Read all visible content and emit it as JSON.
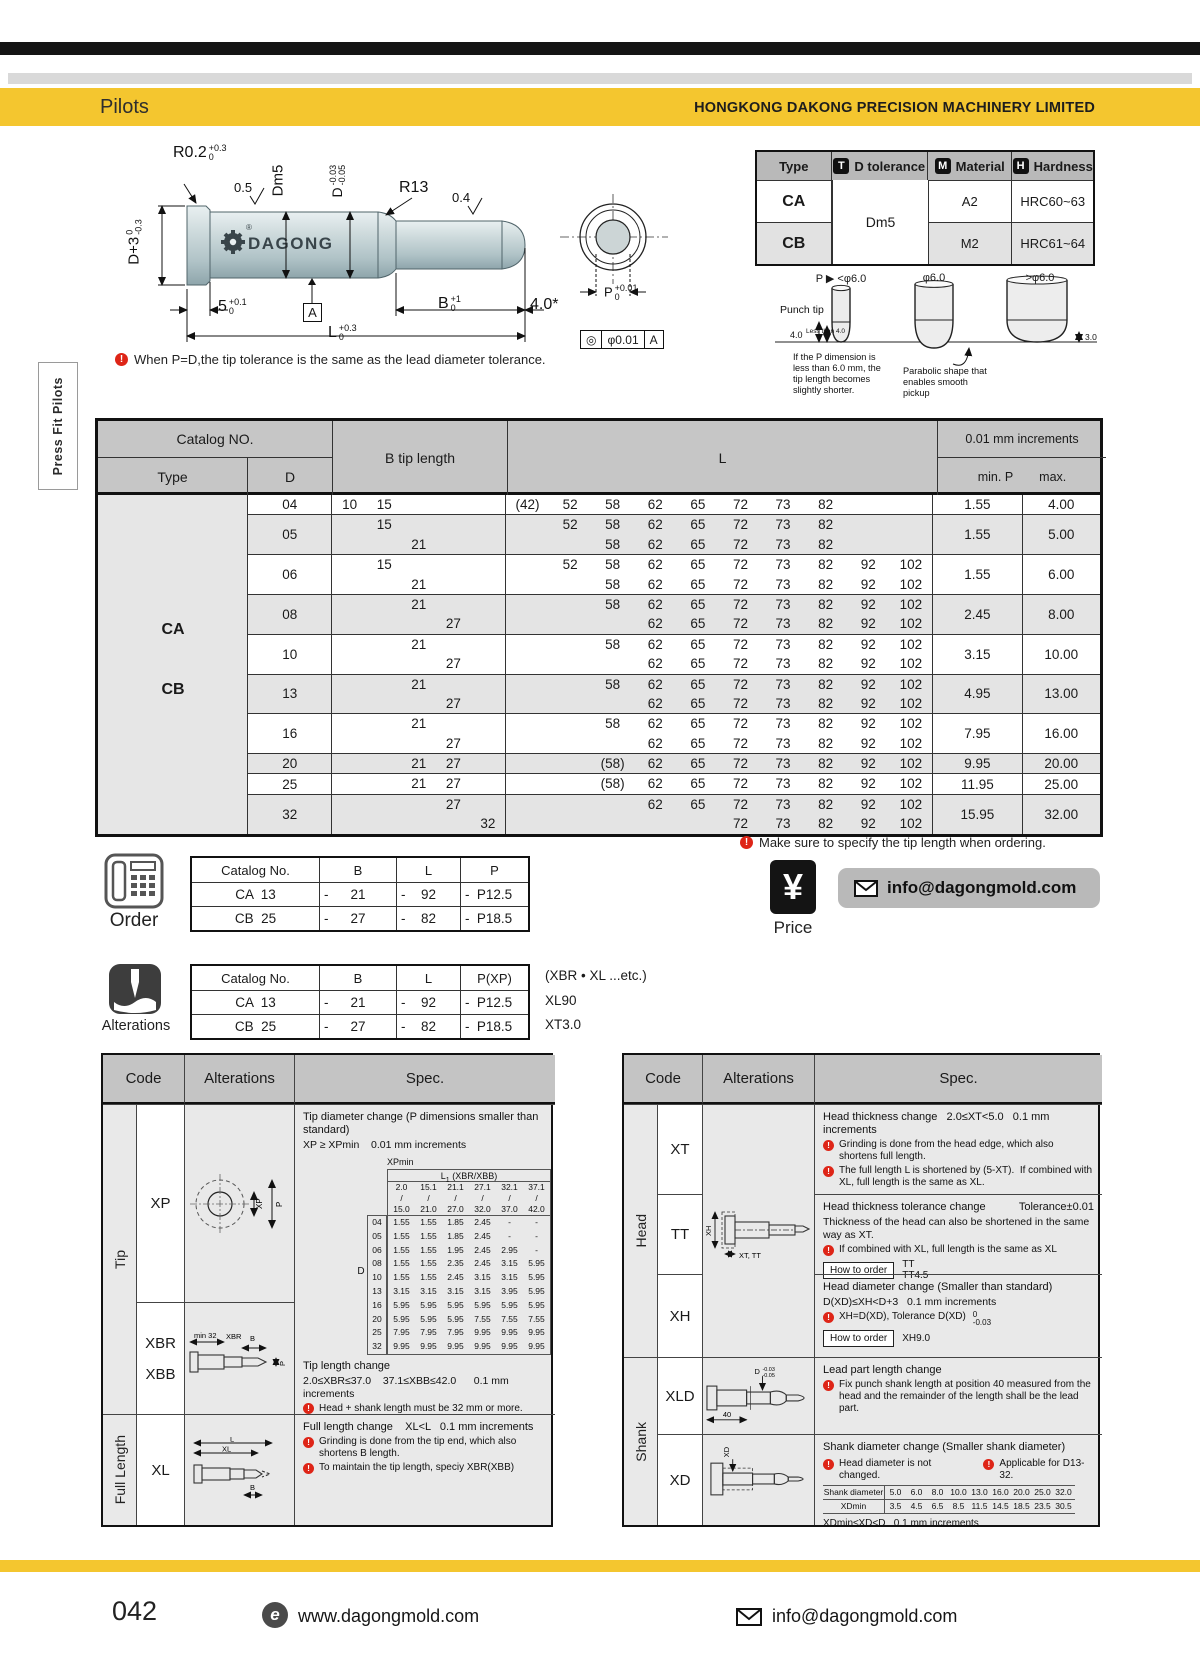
{
  "header": {
    "section_title": "Pilots",
    "company": "HONGKONG DAKONG PRECISION MACHINERY LIMITED"
  },
  "side_tab": {
    "label": "Press Fit Pilots"
  },
  "drawing": {
    "logo_text": "DAGONG",
    "logo_reg": "®",
    "dims": {
      "r02": {
        "base": "R0.2",
        "sup": "+0.3",
        "sub": "0"
      },
      "finish_05": "0.5",
      "dm5": "Dm5",
      "d_tol": {
        "base": "D",
        "sup": "-0.03",
        "sub": "-0.05"
      },
      "r13": "R13",
      "finish_04": "0.4",
      "d_head": {
        "base": "D+3",
        "sup": "0",
        "sub": "-0.3"
      },
      "head_len": {
        "base": "5",
        "sup": "+0.1",
        "sub": "0"
      },
      "datum": "A",
      "b_len": {
        "base": "B",
        "sup": "+1",
        "sub": "0"
      },
      "tip_len": "4.0*",
      "full_len": {
        "base": "L",
        "sup": "+0.3",
        "sub": "0"
      },
      "p_dia": {
        "base": "P",
        "sup": "+0.01",
        "sub": "0"
      },
      "fcf": {
        "sym": "◎",
        "tol": "φ0.01",
        "datum": "A"
      }
    },
    "note": "When P=D,the tip tolerance is the same as the lead diameter tolerance."
  },
  "type_table": {
    "headers": {
      "type": "Type",
      "d_tol": "D tolerance",
      "material": "Material",
      "hardness": "Hardness"
    },
    "badges": {
      "t": "T",
      "m": "M",
      "h": "H"
    },
    "d_tol_value": "Dm5",
    "rows": [
      {
        "type": "CA",
        "material": "A2",
        "hardness": "HRC60~63"
      },
      {
        "type": "CB",
        "material": "M2",
        "hardness": "HRC61~64"
      }
    ]
  },
  "punch_tip": {
    "col_labels": [
      "P ▶ <φ6.0",
      "φ6.0",
      ">φ6.0"
    ],
    "punch_tip_label": "Punch tip",
    "dim_4": "4.0",
    "less_than_4": "Less than 4.0",
    "dim_3": "3.0",
    "note_left": "If the P dimension is less than 6.0 mm, the tip length becomes slightly shorter.",
    "note_mid": "Parabolic shape that enables smooth pickup"
  },
  "main_table": {
    "headers": {
      "catalog_no": "Catalog NO.",
      "type": "Type",
      "d": "D",
      "b": "B tip length",
      "l": "L",
      "increments": "0.01 mm increments",
      "min_p": "min. P",
      "max": "max."
    },
    "type_labels": [
      "CA",
      "CB"
    ],
    "rows": [
      {
        "d": "04",
        "shaded": false,
        "b": [
          [
            "10",
            "15",
            "",
            "",
            ""
          ]
        ],
        "l": [
          [
            "(42)",
            "52",
            "58",
            "62",
            "65",
            "72",
            "73",
            "82",
            "",
            ""
          ]
        ],
        "p_min": "1.55",
        "p_max": "4.00"
      },
      {
        "d": "05",
        "shaded": true,
        "b": [
          [
            "",
            "15",
            "",
            "",
            ""
          ],
          [
            "",
            "",
            "21",
            "",
            ""
          ]
        ],
        "l": [
          [
            "",
            "52",
            "58",
            "62",
            "65",
            "72",
            "73",
            "82",
            "",
            ""
          ],
          [
            "",
            "",
            "58",
            "62",
            "65",
            "72",
            "73",
            "82",
            "",
            ""
          ]
        ],
        "p_min": "1.55",
        "p_max": "5.00"
      },
      {
        "d": "06",
        "shaded": false,
        "b": [
          [
            "",
            "15",
            "",
            "",
            ""
          ],
          [
            "",
            "",
            "21",
            "",
            ""
          ]
        ],
        "l": [
          [
            "",
            "52",
            "58",
            "62",
            "65",
            "72",
            "73",
            "82",
            "92",
            "102"
          ],
          [
            "",
            "",
            "58",
            "62",
            "65",
            "72",
            "73",
            "82",
            "92",
            "102"
          ]
        ],
        "p_min": "1.55",
        "p_max": "6.00"
      },
      {
        "d": "08",
        "shaded": true,
        "b": [
          [
            "",
            "",
            "21",
            "",
            ""
          ],
          [
            "",
            "",
            "",
            "27",
            ""
          ]
        ],
        "l": [
          [
            "",
            "",
            "58",
            "62",
            "65",
            "72",
            "73",
            "82",
            "92",
            "102"
          ],
          [
            "",
            "",
            "",
            "62",
            "65",
            "72",
            "73",
            "82",
            "92",
            "102"
          ]
        ],
        "p_min": "2.45",
        "p_max": "8.00"
      },
      {
        "d": "10",
        "shaded": false,
        "b": [
          [
            "",
            "",
            "21",
            "",
            ""
          ],
          [
            "",
            "",
            "",
            "27",
            ""
          ]
        ],
        "l": [
          [
            "",
            "",
            "58",
            "62",
            "65",
            "72",
            "73",
            "82",
            "92",
            "102"
          ],
          [
            "",
            "",
            "",
            "62",
            "65",
            "72",
            "73",
            "82",
            "92",
            "102"
          ]
        ],
        "p_min": "3.15",
        "p_max": "10.00"
      },
      {
        "d": "13",
        "shaded": true,
        "b": [
          [
            "",
            "",
            "21",
            "",
            ""
          ],
          [
            "",
            "",
            "",
            "27",
            ""
          ]
        ],
        "l": [
          [
            "",
            "",
            "58",
            "62",
            "65",
            "72",
            "73",
            "82",
            "92",
            "102"
          ],
          [
            "",
            "",
            "",
            "62",
            "65",
            "72",
            "73",
            "82",
            "92",
            "102"
          ]
        ],
        "p_min": "4.95",
        "p_max": "13.00"
      },
      {
        "d": "16",
        "shaded": false,
        "b": [
          [
            "",
            "",
            "21",
            "",
            ""
          ],
          [
            "",
            "",
            "",
            "27",
            ""
          ]
        ],
        "l": [
          [
            "",
            "",
            "58",
            "62",
            "65",
            "72",
            "73",
            "82",
            "92",
            "102"
          ],
          [
            "",
            "",
            "",
            "62",
            "65",
            "72",
            "73",
            "82",
            "92",
            "102"
          ]
        ],
        "p_min": "7.95",
        "p_max": "16.00"
      },
      {
        "d": "20",
        "shaded": true,
        "b": [
          [
            "",
            "",
            "21",
            "27",
            ""
          ]
        ],
        "l": [
          [
            "",
            "",
            "(58)",
            "62",
            "65",
            "72",
            "73",
            "82",
            "92",
            "102"
          ]
        ],
        "p_min": "9.95",
        "p_max": "20.00"
      },
      {
        "d": "25",
        "shaded": false,
        "b": [
          [
            "",
            "",
            "21",
            "27",
            ""
          ]
        ],
        "l": [
          [
            "",
            "",
            "(58)",
            "62",
            "65",
            "72",
            "73",
            "82",
            "92",
            "102"
          ]
        ],
        "p_min": "11.95",
        "p_max": "25.00"
      },
      {
        "d": "32",
        "shaded": true,
        "b": [
          [
            "",
            "",
            "",
            "27",
            ""
          ],
          [
            "",
            "",
            "",
            "",
            "32"
          ]
        ],
        "l": [
          [
            "",
            "",
            "",
            "62",
            "65",
            "72",
            "73",
            "82",
            "92",
            "102"
          ],
          [
            "",
            "",
            "",
            "",
            "",
            "72",
            "73",
            "82",
            "92",
            "102"
          ]
        ],
        "p_min": "15.95",
        "p_max": "32.00"
      }
    ],
    "order_note": "Make sure to specify the tip length when ordering."
  },
  "order": {
    "label": "Order",
    "headers": [
      "Catalog No.",
      "B",
      "L",
      "P"
    ],
    "dash": "-",
    "rows": [
      {
        "catalog": "CA  13",
        "b": "21",
        "l": "92",
        "p": "P12.5"
      },
      {
        "catalog": "CB  25",
        "b": "27",
        "l": "82",
        "p": "P18.5"
      }
    ]
  },
  "price": {
    "label": "Price",
    "symbol": "¥",
    "email": "info@dagongmold.com"
  },
  "alterations_order": {
    "label": "Alterations",
    "headers": [
      "Catalog No.",
      "B",
      "L",
      "P(XP)"
    ],
    "note": "(XBR • XL ...etc.)",
    "dash": "-",
    "rows": [
      {
        "catalog": "CA  13",
        "b": "21",
        "l": "92",
        "p": "P12.5",
        "alt": "XL90"
      },
      {
        "catalog": "CB  25",
        "b": "27",
        "l": "82",
        "p": "P18.5",
        "alt": "XT3.0"
      }
    ]
  },
  "left_spec_table": {
    "headers": {
      "code": "Code",
      "alterations": "Alterations",
      "spec": "Spec."
    },
    "groups": {
      "tip": "Tip",
      "full_length": "Full Length"
    },
    "xp": {
      "code": "XP",
      "diagram_labels": {
        "xp": "XP",
        "p": "P"
      },
      "title": "Tip diameter change (P dimensions smaller than standard)",
      "rule": "XP ≥ XPmin    0.01 mm increments",
      "xpmin_label": "XPmin",
      "xpmin_header_base": "L",
      "xpmin_header_sub": "1",
      "xpmin_header_rest": " (XBR/XBB)",
      "d_label": "D",
      "col_ranges": [
        [
          "2.0",
          "15.0"
        ],
        [
          "15.1",
          "21.0"
        ],
        [
          "21.1",
          "27.0"
        ],
        [
          "27.1",
          "32.0"
        ],
        [
          "32.1",
          "37.0"
        ],
        [
          "37.1",
          "42.0"
        ]
      ],
      "rows": [
        {
          "d": "04",
          "v": [
            "1.55",
            "1.55",
            "1.85",
            "2.45",
            "-",
            "-"
          ]
        },
        {
          "d": "05",
          "v": [
            "1.55",
            "1.55",
            "1.85",
            "2.45",
            "-",
            "-"
          ]
        },
        {
          "d": "06",
          "v": [
            "1.55",
            "1.55",
            "1.95",
            "2.45",
            "2.95",
            "-"
          ]
        },
        {
          "d": "08",
          "v": [
            "1.55",
            "1.55",
            "2.35",
            "2.45",
            "3.15",
            "5.95"
          ]
        },
        {
          "d": "10",
          "v": [
            "1.55",
            "1.55",
            "2.45",
            "3.15",
            "3.15",
            "5.95"
          ]
        },
        {
          "d": "13",
          "v": [
            "3.15",
            "3.15",
            "3.15",
            "3.15",
            "3.95",
            "5.95"
          ]
        },
        {
          "d": "16",
          "v": [
            "5.95",
            "5.95",
            "5.95",
            "5.95",
            "5.95",
            "5.95"
          ]
        },
        {
          "d": "20",
          "v": [
            "5.95",
            "5.95",
            "5.95",
            "7.55",
            "7.55",
            "7.55"
          ]
        },
        {
          "d": "25",
          "v": [
            "7.95",
            "7.95",
            "7.95",
            "9.95",
            "9.95",
            "9.95"
          ]
        },
        {
          "d": "32",
          "v": [
            "9.95",
            "9.95",
            "9.95",
            "9.95",
            "9.95",
            "9.95"
          ]
        }
      ]
    },
    "xbr": {
      "code1": "XBR",
      "code2": "XBB",
      "diagram_labels": {
        "min32": "min 32",
        "xbr": "XBR",
        "b": "B",
        "p": "P"
      },
      "title": "Tip length change",
      "rule": "2.0≤XBR≤37.0    37.1≤XBB≤42.0      0.1 mm increments",
      "warn": "Head + shank length must be 32 mm or more."
    },
    "xl": {
      "code": "XL",
      "diagram_labels": {
        "l": "L",
        "xl": "XL",
        "b": "B"
      },
      "title": "Full length change    XL<L   0.1 mm increments",
      "warn1": "Grinding is done from the tip end, which also shortens B length.",
      "warn2": "To maintain the tip length, speciy XBR(XBB)"
    }
  },
  "right_spec_table": {
    "headers": {
      "code": "Code",
      "alterations": "Alterations",
      "spec": "Spec."
    },
    "groups": {
      "head": "Head",
      "shank": "Shank"
    },
    "xt": {
      "code": "XT",
      "title": "Head thickness change   2.0≤XT<5.0   0.1 mm increments",
      "warn1": "Grinding is done from the head edge, which also shortens full length.",
      "warn2": "The full length L is shortened by (5-XT).  If combined with XL, full length is the same as XL."
    },
    "tt": {
      "code": "TT",
      "diagram_labels": {
        "xh": "XH",
        "xttt": "XT, TT"
      },
      "title": "Head thickness tolerance change",
      "tolerance": "Tolerance±0.01",
      "line2": "Thickness of the head can also be shortened in the same way as XT.",
      "warn": "If combined with XL, full length is the same as XL",
      "how_to_order": "How to order",
      "order_ex1": "TT",
      "order_ex2": "TT4.5"
    },
    "xh": {
      "code": "XH",
      "title": "Head diameter change (Smaller than standard)",
      "rule": "D(XD)≤XH<D+3   0.1 mm increments",
      "warn_base": "XH=D(XD), Tolerance D(XD)",
      "warn_sup": "0",
      "warn_sub": "-0.03",
      "how_to_order": "How to order",
      "order_ex": "XH9.0"
    },
    "xld": {
      "code": "XLD",
      "diagram_labels": {
        "d_base": "D",
        "d_sup": "-0.03",
        "d_sub": "-0.05",
        "dim40": "40"
      },
      "title": "Lead part length change",
      "warn": "Fix punch shank length at position 40 measured from the head and the remainder of the length shall be the lead part."
    },
    "xd": {
      "code": "XD",
      "diagram_labels": {
        "xd": "XD"
      },
      "title": "Shank diameter change (Smaller shank diameter)",
      "warn1": "Head diameter is not changed.",
      "warn2": "Applicable for D13-32.",
      "table": {
        "row1_label": "Shank diameter",
        "row1": [
          "5.0",
          "6.0",
          "8.0",
          "10.0",
          "13.0",
          "16.0",
          "20.0",
          "25.0",
          "32.0"
        ],
        "row2_label": "XDmin",
        "row2": [
          "3.5",
          "4.5",
          "6.5",
          "8.5",
          "11.5",
          "14.5",
          "18.5",
          "23.5",
          "30.5"
        ]
      },
      "rule": "XDmin≤XD<D   0.1 mm increments"
    }
  },
  "footer": {
    "page_number": "042",
    "website": "www.dagongmold.com",
    "email": "info@dagongmold.com"
  },
  "colors": {
    "accent_yellow": "#F4C62F",
    "table_header_gray": "#c6c6c6",
    "row_alt_gray": "#e4e4e4",
    "warning_red": "#de2517"
  }
}
